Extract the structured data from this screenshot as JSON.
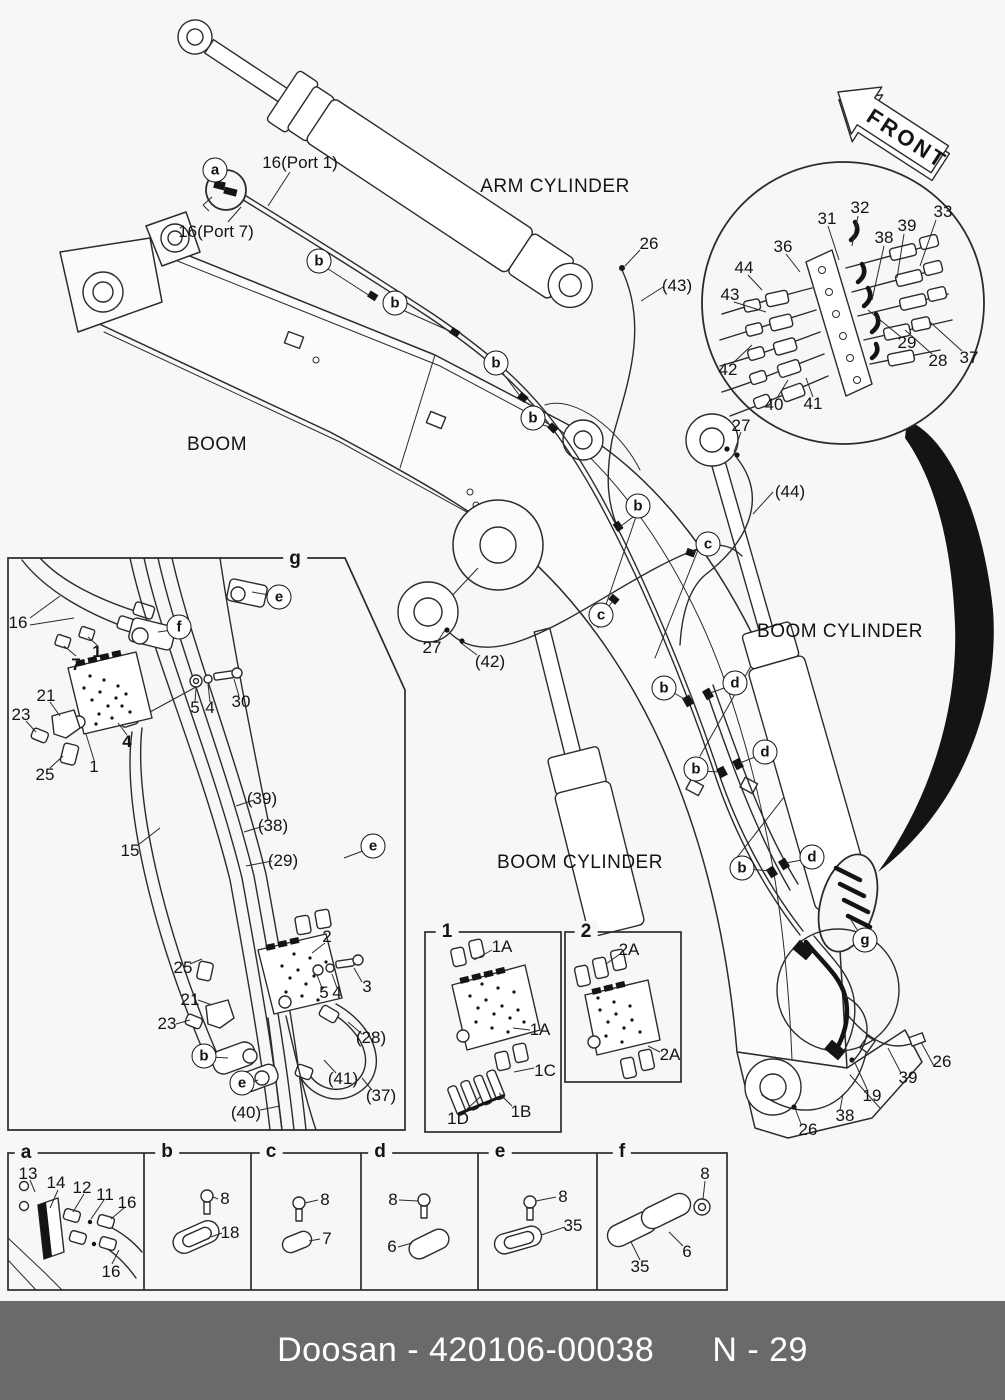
{
  "footer": {
    "doc_id": "Doosan - 420106-00038",
    "page_no": "N - 29"
  },
  "colors": {
    "background": "#f7f7f7",
    "line": "#2b2b2b",
    "footer_bg": "#6a6a6a",
    "footer_text": "#ffffff"
  },
  "front_arrow": {
    "label": "FRONT"
  },
  "component_labels": [
    {
      "t": "ARM CYLINDER",
      "x": 555,
      "y": 187
    },
    {
      "t": "BOOM",
      "x": 217,
      "y": 445
    },
    {
      "t": "BOOM CYLINDER",
      "x": 840,
      "y": 632
    },
    {
      "t": "BOOM CYLINDER",
      "x": 580,
      "y": 863
    }
  ],
  "part_labels": [
    {
      "t": "16(Port 1)",
      "x": 300,
      "y": 163
    },
    {
      "t": "16(Port 7)",
      "x": 216,
      "y": 232
    },
    {
      "t": "26",
      "x": 649,
      "y": 244
    },
    {
      "t": "(43)",
      "x": 677,
      "y": 286
    },
    {
      "t": "27",
      "x": 741,
      "y": 426
    },
    {
      "t": "(44)",
      "x": 790,
      "y": 492
    },
    {
      "t": "27",
      "x": 432,
      "y": 648
    },
    {
      "t": "(42)",
      "x": 490,
      "y": 662
    },
    {
      "t": "26",
      "x": 942,
      "y": 1062
    },
    {
      "t": "39",
      "x": 908,
      "y": 1078
    },
    {
      "t": "19",
      "x": 872,
      "y": 1096
    },
    {
      "t": "38",
      "x": 845,
      "y": 1116
    },
    {
      "t": "26",
      "x": 808,
      "y": 1130
    },
    {
      "t": "31",
      "x": 827,
      "y": 219
    },
    {
      "t": "32",
      "x": 860,
      "y": 208
    },
    {
      "t": "33",
      "x": 943,
      "y": 212
    },
    {
      "t": "39",
      "x": 907,
      "y": 226
    },
    {
      "t": "38",
      "x": 884,
      "y": 238
    },
    {
      "t": "36",
      "x": 783,
      "y": 247
    },
    {
      "t": "44",
      "x": 744,
      "y": 268
    },
    {
      "t": "43",
      "x": 730,
      "y": 295
    },
    {
      "t": "42",
      "x": 728,
      "y": 370
    },
    {
      "t": "40",
      "x": 774,
      "y": 405
    },
    {
      "t": "41",
      "x": 813,
      "y": 404
    },
    {
      "t": "29",
      "x": 907,
      "y": 343
    },
    {
      "t": "28",
      "x": 938,
      "y": 361
    },
    {
      "t": "37",
      "x": 969,
      "y": 358
    },
    {
      "t": "16",
      "x": 18,
      "y": 623
    },
    {
      "t": "7",
      "x": 76,
      "y": 665,
      "b": true
    },
    {
      "t": "1",
      "x": 97,
      "y": 652,
      "b": true
    },
    {
      "t": "21",
      "x": 46,
      "y": 696
    },
    {
      "t": "23",
      "x": 21,
      "y": 715
    },
    {
      "t": "25",
      "x": 45,
      "y": 775
    },
    {
      "t": "1",
      "x": 94,
      "y": 767
    },
    {
      "t": "4",
      "x": 127,
      "y": 742,
      "b": true
    },
    {
      "t": "5",
      "x": 195,
      "y": 708
    },
    {
      "t": "4",
      "x": 210,
      "y": 708
    },
    {
      "t": "30",
      "x": 241,
      "y": 702
    },
    {
      "t": "15",
      "x": 130,
      "y": 851
    },
    {
      "t": "(39)",
      "x": 262,
      "y": 799
    },
    {
      "t": "(38)",
      "x": 273,
      "y": 826
    },
    {
      "t": "(29)",
      "x": 283,
      "y": 861
    },
    {
      "t": "2",
      "x": 327,
      "y": 937
    },
    {
      "t": "25",
      "x": 183,
      "y": 968
    },
    {
      "t": "5",
      "x": 324,
      "y": 993
    },
    {
      "t": "4",
      "x": 337,
      "y": 993
    },
    {
      "t": "3",
      "x": 367,
      "y": 987
    },
    {
      "t": "21",
      "x": 190,
      "y": 1000
    },
    {
      "t": "23",
      "x": 167,
      "y": 1024
    },
    {
      "t": "(28)",
      "x": 371,
      "y": 1038
    },
    {
      "t": "(41)",
      "x": 343,
      "y": 1079
    },
    {
      "t": "(37)",
      "x": 381,
      "y": 1096
    },
    {
      "t": "(40)",
      "x": 246,
      "y": 1113
    },
    {
      "t": "1A",
      "x": 502,
      "y": 947
    },
    {
      "t": "1A",
      "x": 540,
      "y": 1030
    },
    {
      "t": "1C",
      "x": 545,
      "y": 1071
    },
    {
      "t": "1D",
      "x": 458,
      "y": 1119
    },
    {
      "t": "1B",
      "x": 521,
      "y": 1112
    },
    {
      "t": "2A",
      "x": 629,
      "y": 950
    },
    {
      "t": "2A",
      "x": 670,
      "y": 1055
    },
    {
      "t": "13",
      "x": 28,
      "y": 1174
    },
    {
      "t": "14",
      "x": 56,
      "y": 1183
    },
    {
      "t": "12",
      "x": 82,
      "y": 1188
    },
    {
      "t": "11",
      "x": 105,
      "y": 1195
    },
    {
      "t": "16",
      "x": 127,
      "y": 1203
    },
    {
      "t": "16",
      "x": 111,
      "y": 1272
    },
    {
      "t": "8",
      "x": 225,
      "y": 1199
    },
    {
      "t": "18",
      "x": 230,
      "y": 1233
    },
    {
      "t": "8",
      "x": 325,
      "y": 1200
    },
    {
      "t": "7",
      "x": 327,
      "y": 1239
    },
    {
      "t": "8",
      "x": 393,
      "y": 1200
    },
    {
      "t": "6",
      "x": 392,
      "y": 1247
    },
    {
      "t": "8",
      "x": 563,
      "y": 1197
    },
    {
      "t": "35",
      "x": 573,
      "y": 1226
    },
    {
      "t": "8",
      "x": 705,
      "y": 1174
    },
    {
      "t": "6",
      "x": 687,
      "y": 1252
    },
    {
      "t": "35",
      "x": 640,
      "y": 1267
    }
  ],
  "callout_circles": [
    {
      "l": "a",
      "x": 215,
      "y": 170
    },
    {
      "l": "b",
      "x": 319,
      "y": 261
    },
    {
      "l": "b",
      "x": 395,
      "y": 303
    },
    {
      "l": "b",
      "x": 496,
      "y": 363
    },
    {
      "l": "b",
      "x": 533,
      "y": 418
    },
    {
      "l": "b",
      "x": 638,
      "y": 506
    },
    {
      "l": "c",
      "x": 708,
      "y": 544
    },
    {
      "l": "c",
      "x": 601,
      "y": 615
    },
    {
      "l": "b",
      "x": 664,
      "y": 688
    },
    {
      "l": "d",
      "x": 735,
      "y": 683
    },
    {
      "l": "b",
      "x": 696,
      "y": 769
    },
    {
      "l": "d",
      "x": 765,
      "y": 752
    },
    {
      "l": "b",
      "x": 742,
      "y": 868
    },
    {
      "l": "d",
      "x": 812,
      "y": 857
    },
    {
      "l": "g",
      "x": 865,
      "y": 940
    },
    {
      "l": "e",
      "x": 279,
      "y": 597
    },
    {
      "l": "f",
      "x": 179,
      "y": 627
    },
    {
      "l": "e",
      "x": 373,
      "y": 846
    },
    {
      "l": "b",
      "x": 204,
      "y": 1056
    },
    {
      "l": "e",
      "x": 242,
      "y": 1083
    }
  ],
  "section_tags": [
    {
      "t": "g",
      "x": 295,
      "y": 559
    },
    {
      "t": "1",
      "x": 447,
      "y": 932
    },
    {
      "t": "2",
      "x": 586,
      "y": 932
    },
    {
      "t": "a",
      "x": 26,
      "y": 1153
    },
    {
      "t": "b",
      "x": 167,
      "y": 1152
    },
    {
      "t": "c",
      "x": 271,
      "y": 1152
    },
    {
      "t": "d",
      "x": 380,
      "y": 1152
    },
    {
      "t": "e",
      "x": 500,
      "y": 1152
    },
    {
      "t": "f",
      "x": 622,
      "y": 1152
    }
  ]
}
